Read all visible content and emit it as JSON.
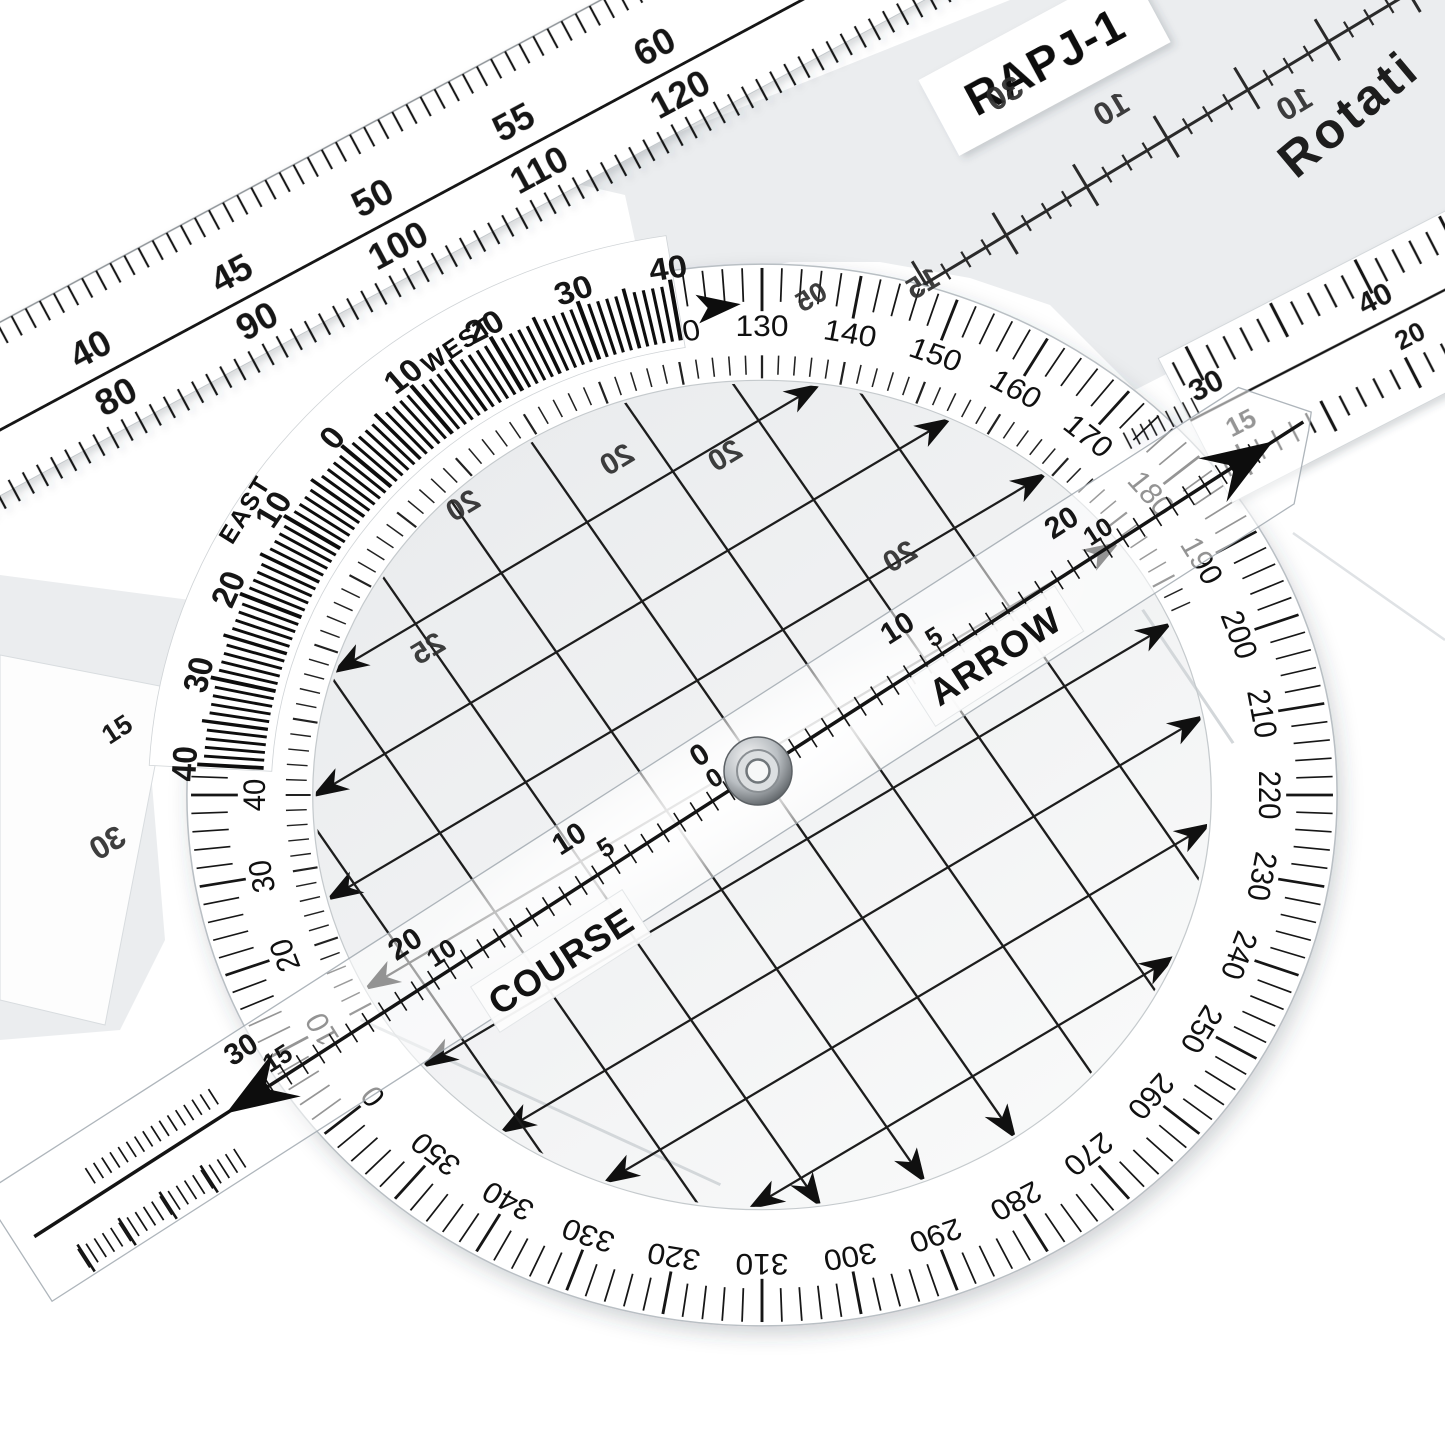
{
  "scene": {
    "description": "Product photo of a transparent rotating azimuth plotter lying over a straight navigation ruler",
    "background_color": "#ffffff",
    "ink_color": "#161616",
    "plate_tint_color": "#ebedef",
    "rivet_color": "#8f959a"
  },
  "stickers": {
    "model": "RAPJ-1",
    "plate_title": "Rotati",
    "course": "COURSE",
    "arrow": "ARROW"
  },
  "compass_rose": {
    "step_degrees": 10,
    "labels": [
      "0",
      "10",
      "20",
      "30",
      "40",
      "50",
      "60",
      "70",
      "80",
      "90",
      "100",
      "110",
      "120",
      "130",
      "140",
      "150",
      "160",
      "170",
      "180",
      "190",
      "200",
      "210",
      "220",
      "230",
      "240",
      "250",
      "260",
      "270",
      "280",
      "290",
      "300",
      "310",
      "320",
      "330",
      "340",
      "350"
    ]
  },
  "vernier": {
    "zero": "0",
    "west_word": "WEST",
    "east_word": "EAST",
    "west_labels": [
      "10",
      "20",
      "30",
      "40"
    ],
    "east_labels": [
      "10",
      "20",
      "30",
      "40"
    ]
  },
  "straight_ruler": {
    "top_scale": [
      "35",
      "40",
      "45",
      "50",
      "55",
      "60"
    ],
    "bottom_scale": [
      "70",
      "80",
      "90",
      "100",
      "110",
      "120"
    ]
  },
  "arm": {
    "zero_labels": [
      "0",
      "0"
    ],
    "right_outer": [
      "10",
      "20"
    ],
    "right_inner": [
      "5",
      "10"
    ],
    "left_outer": [
      "10",
      "20",
      "30"
    ],
    "left_inner": [
      "5",
      "10",
      "15"
    ]
  },
  "edge_ruler": {
    "top_scale": [
      "30",
      "40"
    ],
    "bottom_scale": [
      "15",
      "20"
    ]
  },
  "corner_label": "15",
  "mirrored_labels": [
    {
      "text": "30",
      "x": 1010,
      "y": 103,
      "size": 33
    },
    {
      "text": "10",
      "x": 1117,
      "y": 118,
      "size": 32
    },
    {
      "text": "10",
      "x": 1300,
      "y": 113,
      "size": 32
    },
    {
      "text": "15",
      "x": 928,
      "y": 292,
      "size": 30
    },
    {
      "text": "05",
      "x": 816,
      "y": 305,
      "size": 28
    },
    {
      "text": "20",
      "x": 622,
      "y": 468,
      "size": 30
    },
    {
      "text": "20",
      "x": 730,
      "y": 464,
      "size": 30
    },
    {
      "text": "20",
      "x": 468,
      "y": 514,
      "size": 30
    },
    {
      "text": "25",
      "x": 433,
      "y": 657,
      "size": 30
    },
    {
      "text": "20",
      "x": 905,
      "y": 565,
      "size": 30
    },
    {
      "text": "30",
      "x": 113,
      "y": 852,
      "size": 32
    }
  ]
}
